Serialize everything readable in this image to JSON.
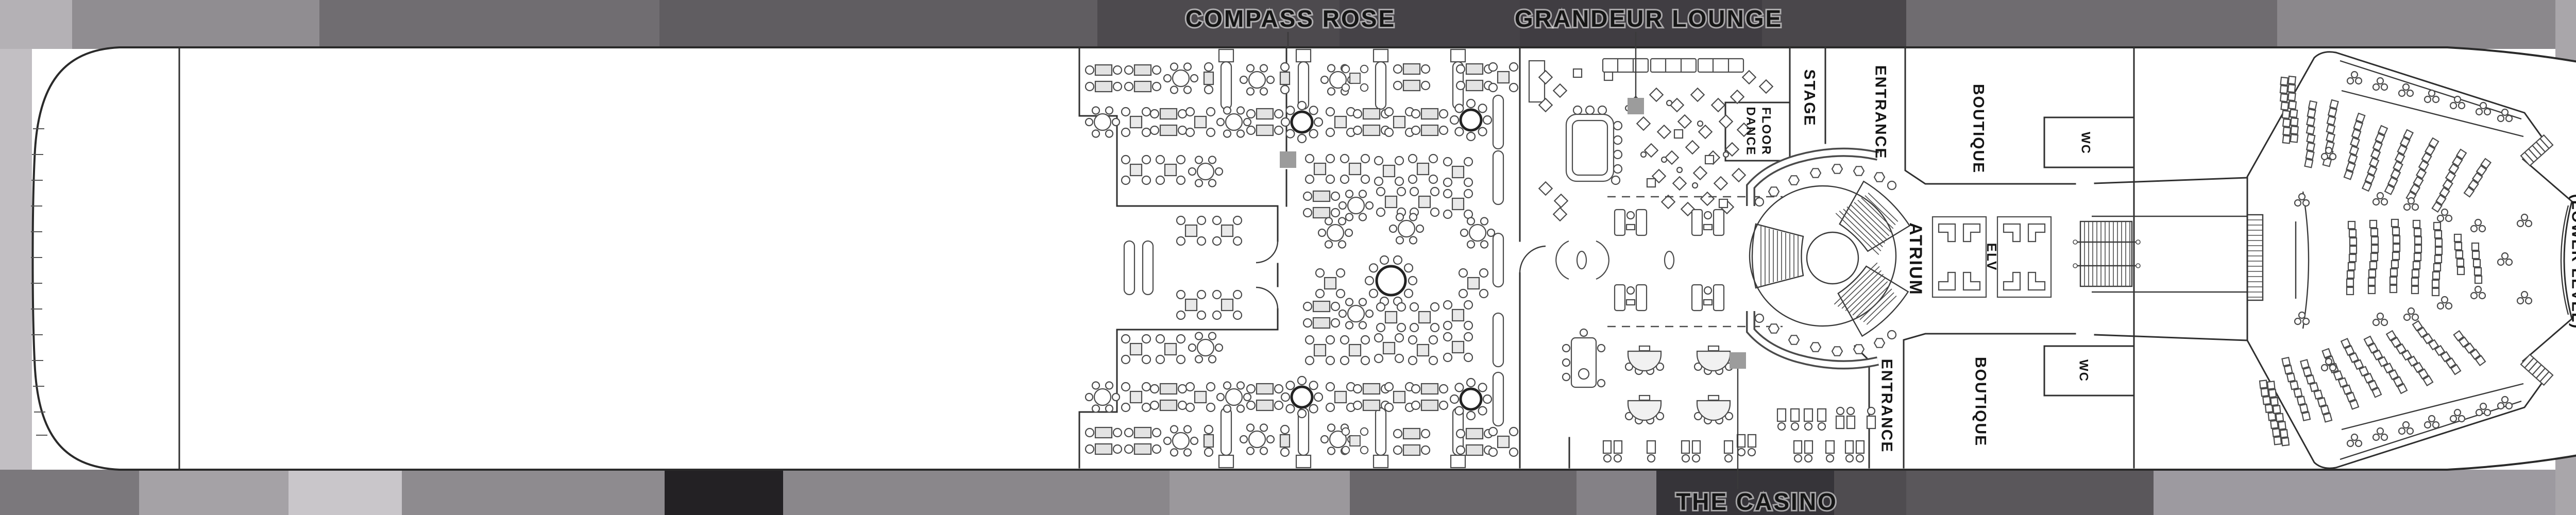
{
  "plan": {
    "type": "cruise-ship-deck-plan",
    "colors": {
      "hull_fill": "#ffffff",
      "outline": "#2f2f2f",
      "band_dark": "#46434a",
      "band_light": "#9d9aa0",
      "leader_square": "#9c9c9c"
    },
    "labels": {
      "compass_rose": "COMPASS ROSE",
      "grandeur_lounge": "GRANDEUR LOUNGE",
      "the_casino": "THE CASINO",
      "stage": "STAGE",
      "dance_floor_line1": "DANCE",
      "dance_floor_line2": "FLOOR",
      "entrance_top": "ENTRANCE",
      "entrance_bottom": "ENTRANCE",
      "atrium": "ATRIUM",
      "elevator": "ELV",
      "boutique_top": "BOUTIQUE",
      "boutique_bottom": "BOUTIQUE",
      "wc_top": "WC",
      "wc_bottom": "WC",
      "theater_line1": "CONSTELLATION",
      "theater_line2": "THEATER",
      "theater_sublevel": "(LOWER LEVEL)"
    }
  }
}
